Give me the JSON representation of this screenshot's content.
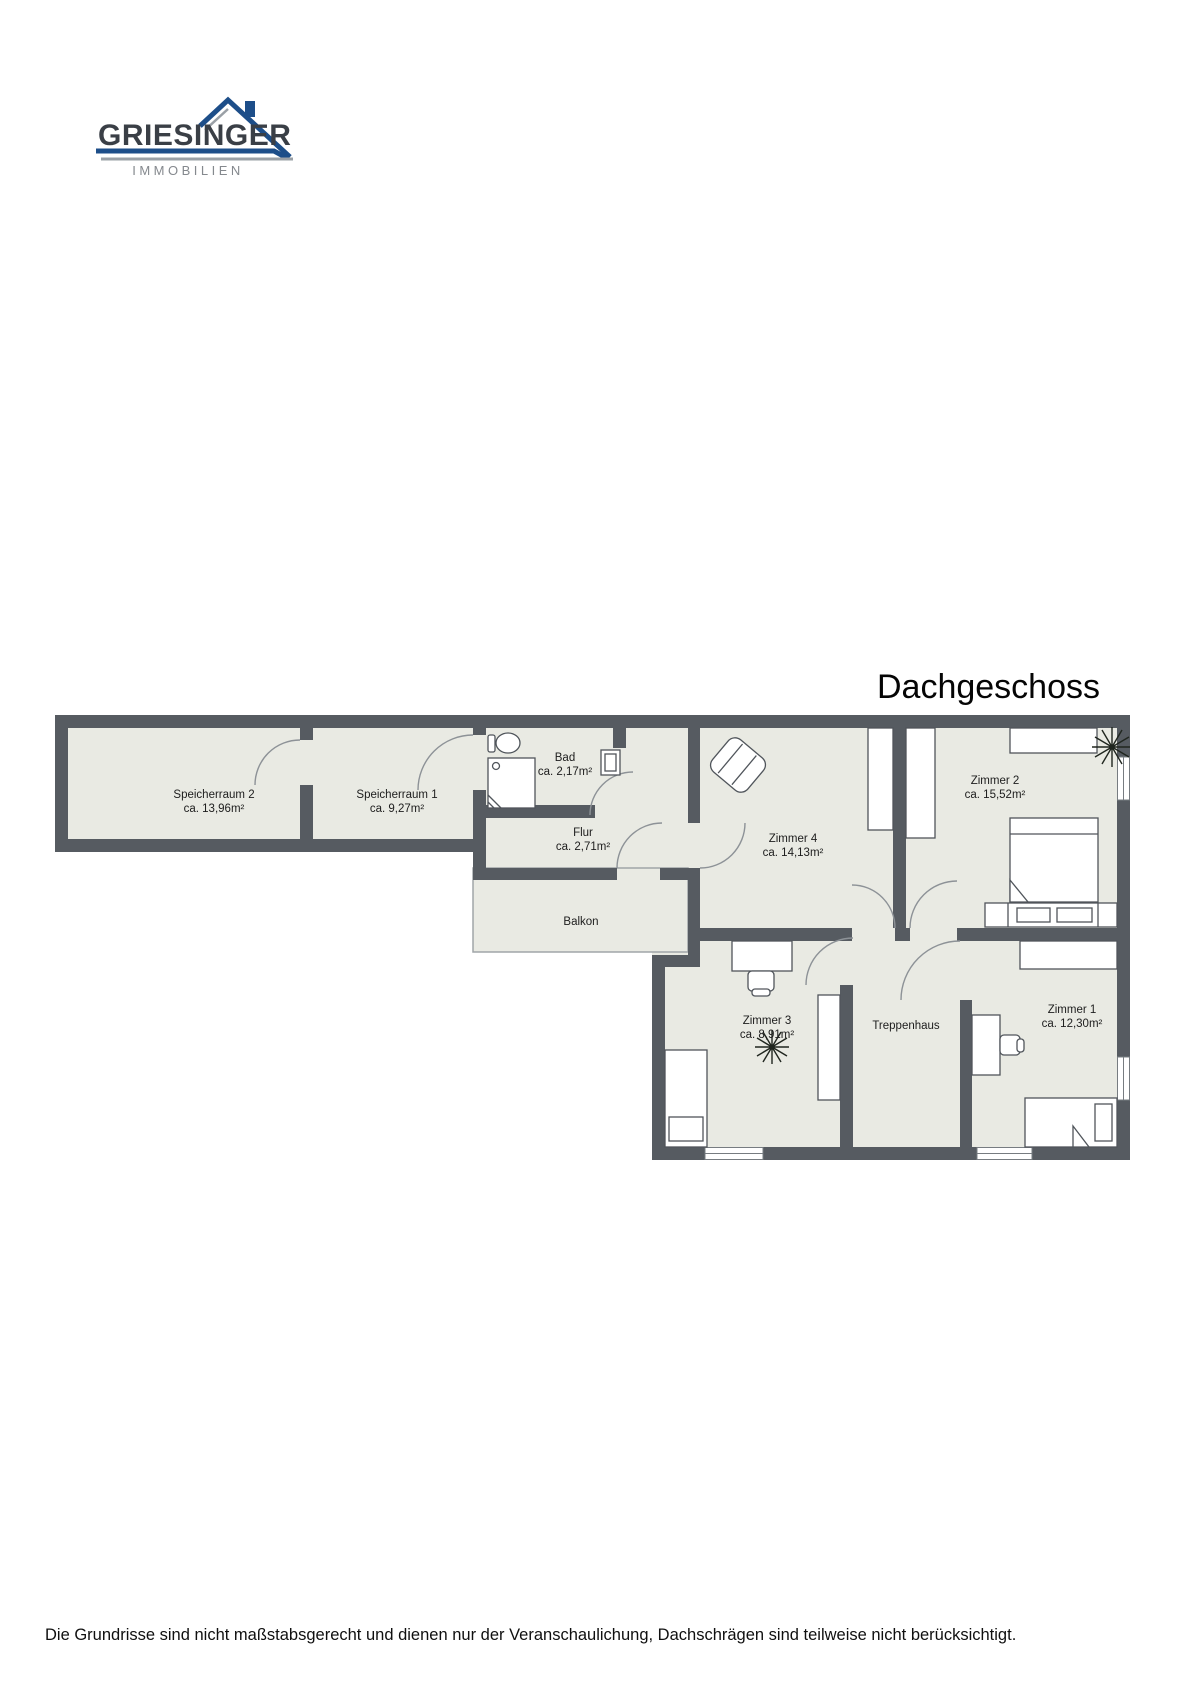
{
  "logo": {
    "brand": "GRIESINGER",
    "tagline": "IMMOBILIEN"
  },
  "title": "Dachgeschoss",
  "floorplan": {
    "rooms": [
      {
        "name": "Speicherraum 2",
        "area": "ca. 13,96m²"
      },
      {
        "name": "Speicherraum 1",
        "area": "ca. 9,27m²"
      },
      {
        "name": "Bad",
        "area": "ca. 2,17m²"
      },
      {
        "name": "Flur",
        "area": "ca. 2,71m²"
      },
      {
        "name": "Balkon",
        "area": ""
      },
      {
        "name": "Zimmer 4",
        "area": "ca. 14,13m²"
      },
      {
        "name": "Zimmer 2",
        "area": "ca. 15,52m²"
      },
      {
        "name": "Zimmer 3",
        "area": "ca. 8,91m²"
      },
      {
        "name": "Treppenhaus",
        "area": ""
      },
      {
        "name": "Zimmer 1",
        "area": "ca. 12,30m²"
      }
    ],
    "colors": {
      "wall": "#565b61",
      "room_fill": "#e9eae3",
      "furniture_stroke": "#50555b",
      "door_arc": "#8d9297",
      "logo_blue": "#1d4e89",
      "logo_gray": "#9aa0a6"
    },
    "icons": {
      "logo_house": "house-roof-icon",
      "plant": "plant-icon"
    }
  },
  "footer": {
    "disclaimer": "Die Grundrisse sind nicht maßstabsgerecht und dienen nur der Veranschaulichung, Dachschrägen sind teilweise nicht berücksichtigt."
  }
}
